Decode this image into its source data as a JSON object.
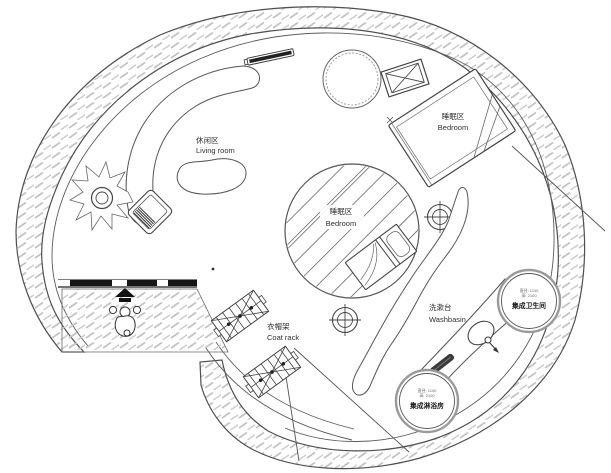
{
  "plan": {
    "zones": {
      "living_room": {
        "zh": "休闲区",
        "en": "Living room"
      },
      "bedroom_upper": {
        "zh": "睡眠区",
        "en": "Bedroom"
      },
      "bedroom_center": {
        "zh": "睡眠区",
        "en": "Bedroom"
      },
      "coat_rack": {
        "zh": "衣帽架",
        "en": "Coat rack"
      },
      "washbasin": {
        "zh": "洗漱台",
        "en": "Washbasin"
      },
      "bathroom_pod": {
        "label": "集成卫生间",
        "spec_diameter": "直径: 1100",
        "spec_height": "高: 2100"
      },
      "shower_pod": {
        "label": "集成淋浴房",
        "spec_diameter": "直径: 1100",
        "spec_height": "高: 2100"
      }
    },
    "symbols": {
      "entry_person": "person-top-view",
      "entry_direction": "arrow-up",
      "column_marker": "crosshair-target",
      "equipment_box": "crossed-box",
      "plant": "potted-plant",
      "round_table": "dashed-circle-table",
      "washbasin_fixture": "basin-with-tap-arrow"
    },
    "colors": {
      "background": "#ffffff",
      "wall_line": "#4a4a4a",
      "hatch": "#c0c0c0",
      "dark_fill": "#161616",
      "text": "#2f2f2f"
    }
  }
}
